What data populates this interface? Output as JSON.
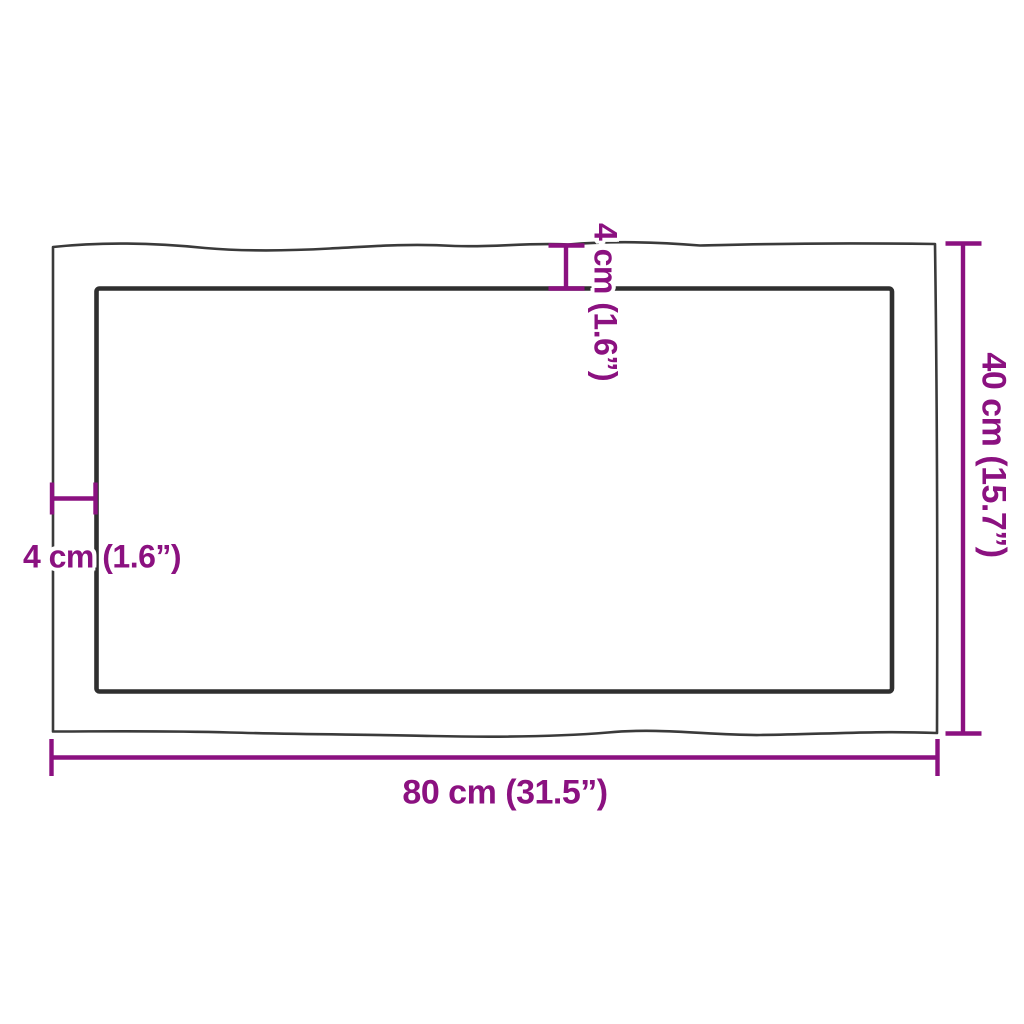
{
  "diagram": {
    "kind": "product-dimension-diagram",
    "subject": "rectangular table top with live edge border, top view",
    "labels": {
      "width": "80 cm (31.5”)",
      "height": "40 cm (15.7”)",
      "edge_left": "4 cm (1.6”)",
      "edge_top": "4 cm (1.6”)"
    },
    "measurements": {
      "width_cm": 80,
      "width_in": 31.5,
      "height_cm": 40,
      "height_in": 15.7,
      "edge_cm": 4,
      "edge_in": 1.6
    },
    "colors": {
      "dimension": "#8B1180",
      "outline_outer": "#3a3a3a",
      "outline_inner": "#2f2f2f",
      "background": "#ffffff"
    }
  }
}
